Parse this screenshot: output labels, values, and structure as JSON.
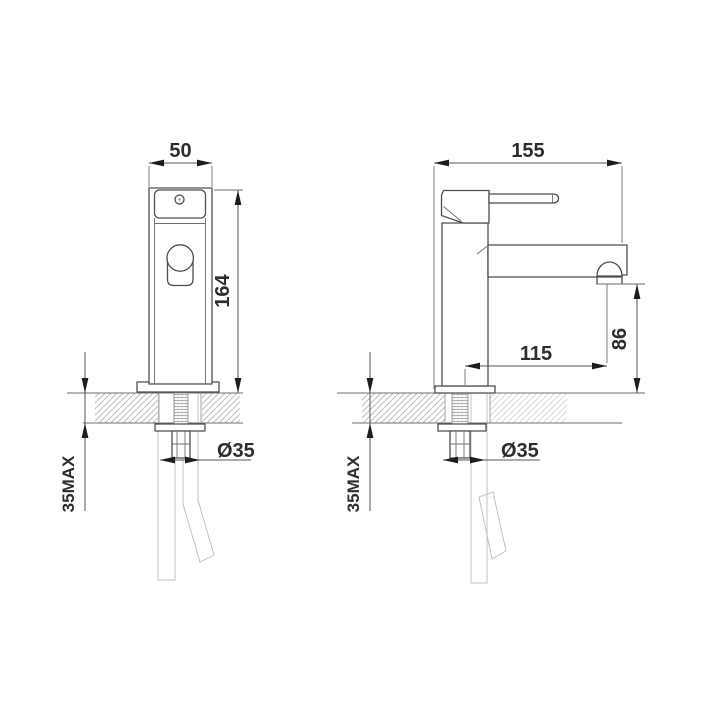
{
  "drawing": {
    "type": "technical-dimension-drawing",
    "subject": "basin mixer tap, front and side installation views",
    "front_view": {
      "width_label": "50",
      "height_label": "164",
      "deck_max_label": "35MAX",
      "hole_label": "Ø35"
    },
    "side_view": {
      "overall_depth_label": "155",
      "spout_reach_label": "115",
      "outlet_height_label": "86",
      "deck_max_label": "35MAX",
      "hole_label": "Ø35"
    },
    "colors": {
      "background": "#ffffff",
      "outline": "#4d4d4d",
      "dimension": "#565656",
      "hatch": "#b5b5b5",
      "braid": "#c9c9c9"
    }
  }
}
